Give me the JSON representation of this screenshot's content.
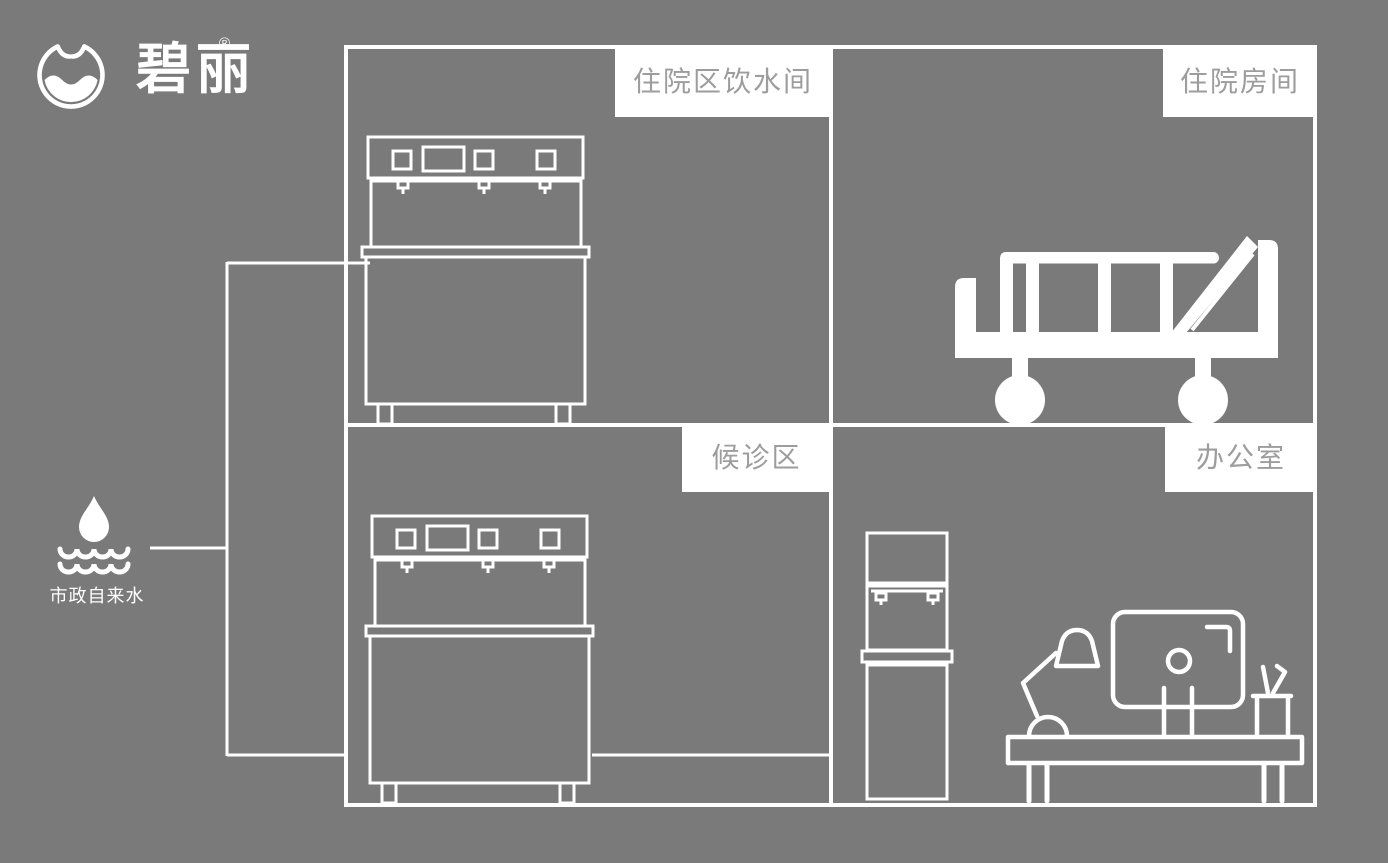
{
  "brand": {
    "name": "碧丽",
    "registered_mark": "®",
    "logo_icon": "water-cup-wave-logo-icon"
  },
  "water_source": {
    "label": "市政自来水",
    "icon": "water-drop-over-waves-icon"
  },
  "floorplan": {
    "rooms": [
      {
        "label": "住院区饮水间",
        "icons": [
          "counter-top-water-dispenser-icon"
        ]
      },
      {
        "label": "住院房间",
        "icons": [
          "hospital-bed-icon"
        ]
      },
      {
        "label": "候诊区",
        "icons": [
          "counter-top-water-dispenser-icon"
        ]
      },
      {
        "label": "办公室",
        "icons": [
          "standing-water-dispenser-icon",
          "desk-lamp-icon",
          "monitor-icon",
          "pen-holder-icon",
          "office-desk-icon"
        ]
      }
    ]
  },
  "pipes": {
    "description": "municipal water line feeding dispensers",
    "junction_y": [
      263,
      755
    ]
  },
  "colors": {
    "background": "#7a7a7b",
    "line": "#ffffff",
    "label_background": "#ffffff",
    "label_text": "#9d9d9d"
  }
}
